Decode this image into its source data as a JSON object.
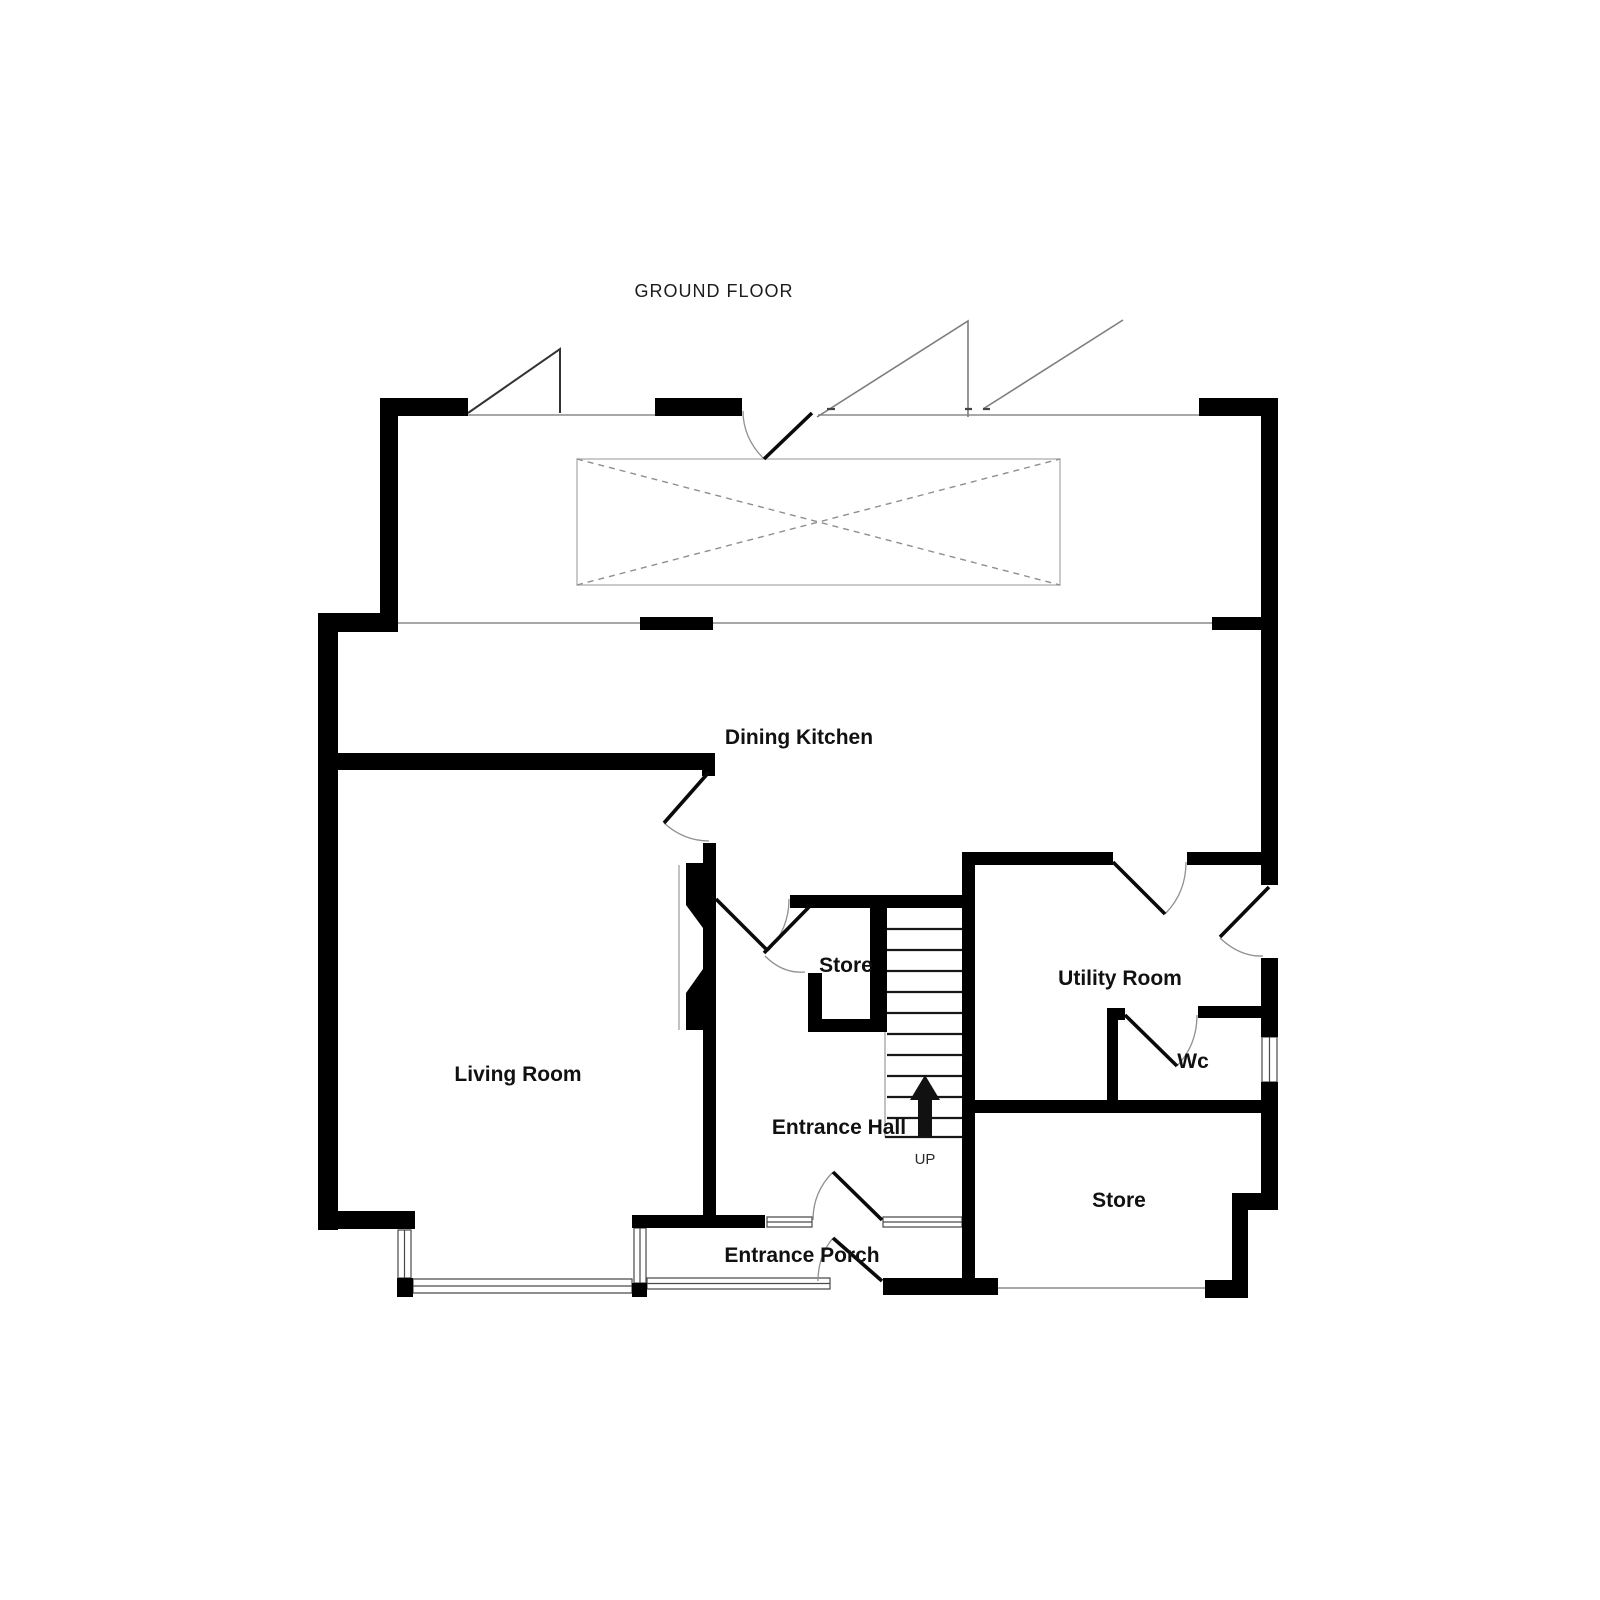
{
  "title": "GROUND FLOOR",
  "rooms": {
    "dining_kitchen": "Dining Kitchen",
    "living_room": "Living Room",
    "hall_store": "Store",
    "entrance_hall": "Entrance Hall",
    "utility_room": "Utility Room",
    "wc": "Wc",
    "rear_store": "Store",
    "entrance_porch": "Entrance Porch"
  },
  "stairs": {
    "direction_label": "UP"
  },
  "colors": {
    "wall": "#000000",
    "opening_line": "#8c8c8c",
    "text": "#111111",
    "background": "#ffffff"
  }
}
